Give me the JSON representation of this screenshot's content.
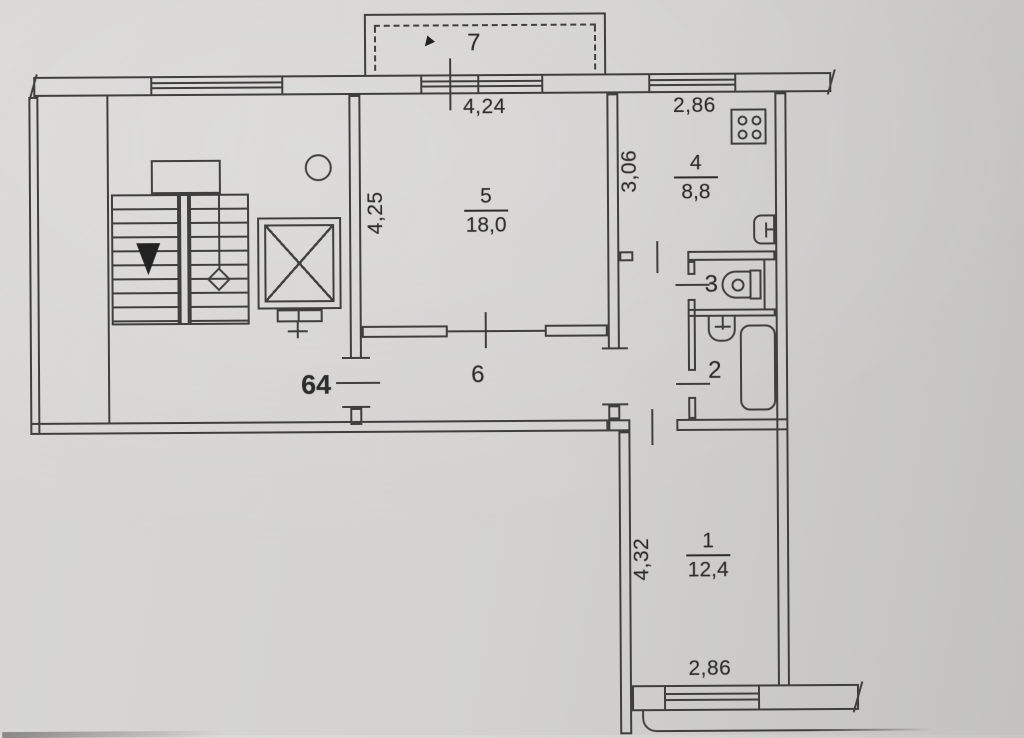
{
  "document": {
    "kind": "scanned apartment floor plan"
  },
  "apartment_number": "64",
  "rooms": {
    "balcony": {
      "number": "7"
    },
    "living_room": {
      "number": "5",
      "area": "18,0"
    },
    "kitchen": {
      "number": "4",
      "area": "8,8"
    },
    "wc": {
      "number": "3"
    },
    "bathroom": {
      "number": "2"
    },
    "hallway": {
      "number": "6"
    },
    "room1": {
      "number": "1",
      "area": "12,4"
    }
  },
  "dimensions": {
    "living_room_width": "4,24",
    "living_room_depth": "4,25",
    "kitchen_width": "2,86",
    "kitchen_depth": "3,06",
    "room1_depth": "4,32",
    "room1_width": "2,86"
  },
  "colors": {
    "paper": "#d2d1cf",
    "ink": "#3f3f3f",
    "text": "#2c2c2c"
  }
}
